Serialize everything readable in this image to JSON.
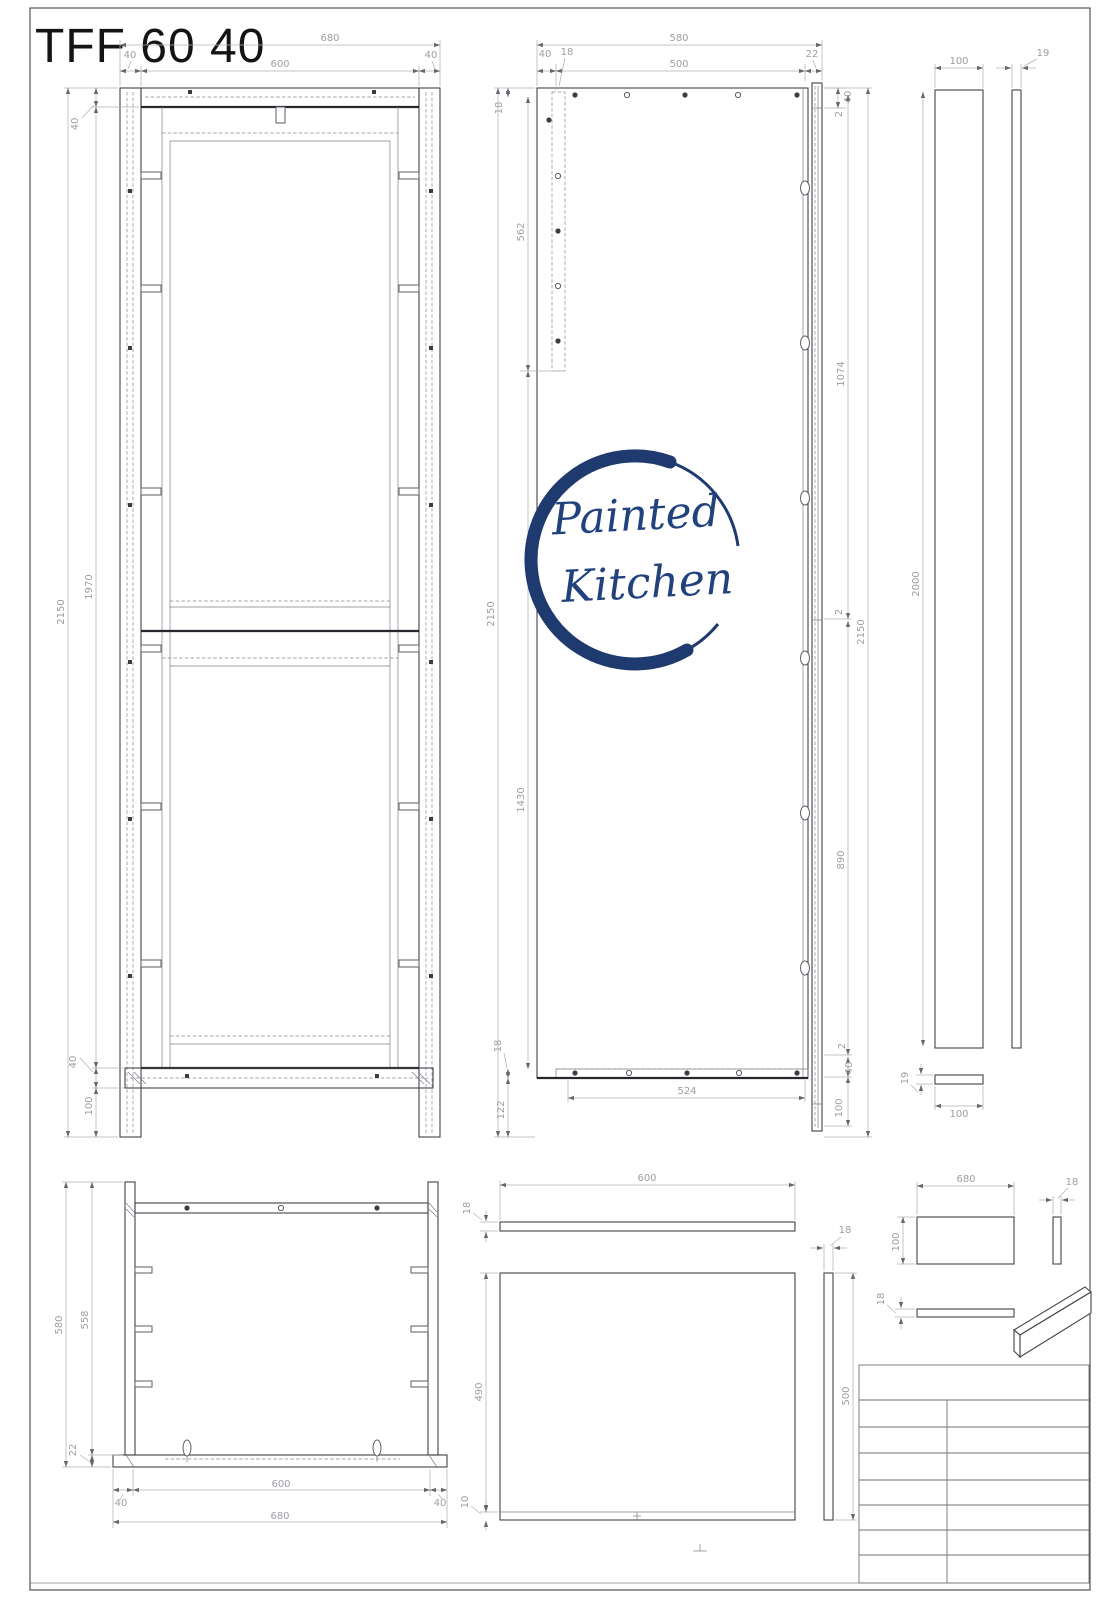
{
  "sheet": {
    "title": "TFF 60 40"
  },
  "logo": {
    "word1": "Painted",
    "word2": "Kitchen",
    "color": "#1e3a6e"
  },
  "colors": {
    "object_line": "#3f444a",
    "dimension": "#9b9fa4",
    "title_text": "#141414",
    "logo_navy": "#1e3a6e"
  },
  "front": {
    "overall_w": "680",
    "inner_w": "600",
    "stile_l": "40",
    "stile_r": "40",
    "top_rail": "40",
    "overall_h": "2150",
    "inner_h": "1970",
    "bottom_rail": "40",
    "leg": "100"
  },
  "side": {
    "overall_d": "580",
    "front_off": "40",
    "strip_t": "18",
    "inner_d": "500",
    "back_t": "22",
    "top_gap": "2",
    "top_rail": "40",
    "left_t18": "18",
    "strip_h": "562",
    "overall_h_l": "2150",
    "mid_h": "1430",
    "bottom_t": "18",
    "bottom_off": "122",
    "bottom_w": "524",
    "pitch_a": "1074",
    "overall_h_r": "2150",
    "gap_mid": "2",
    "pitch_b": "890",
    "gap_bot": "2",
    "rail40": "40",
    "leg": "100"
  },
  "panels": {
    "w": "100",
    "t": "19",
    "h": "2000",
    "bar_t": "19",
    "bar_w": "100"
  },
  "plan": {
    "overall_d": "580",
    "inner_d": "558",
    "plate_t": "22",
    "stile_l": "40",
    "inner_w": "600",
    "stile_r": "40",
    "overall_w": "680"
  },
  "shelf": {
    "w": "600",
    "t": "18",
    "d": "490",
    "edge": "10",
    "strip_t": "18",
    "strip_h": "500"
  },
  "back": {
    "w": "680",
    "h": "100",
    "t": "18",
    "rail_t": "18"
  }
}
